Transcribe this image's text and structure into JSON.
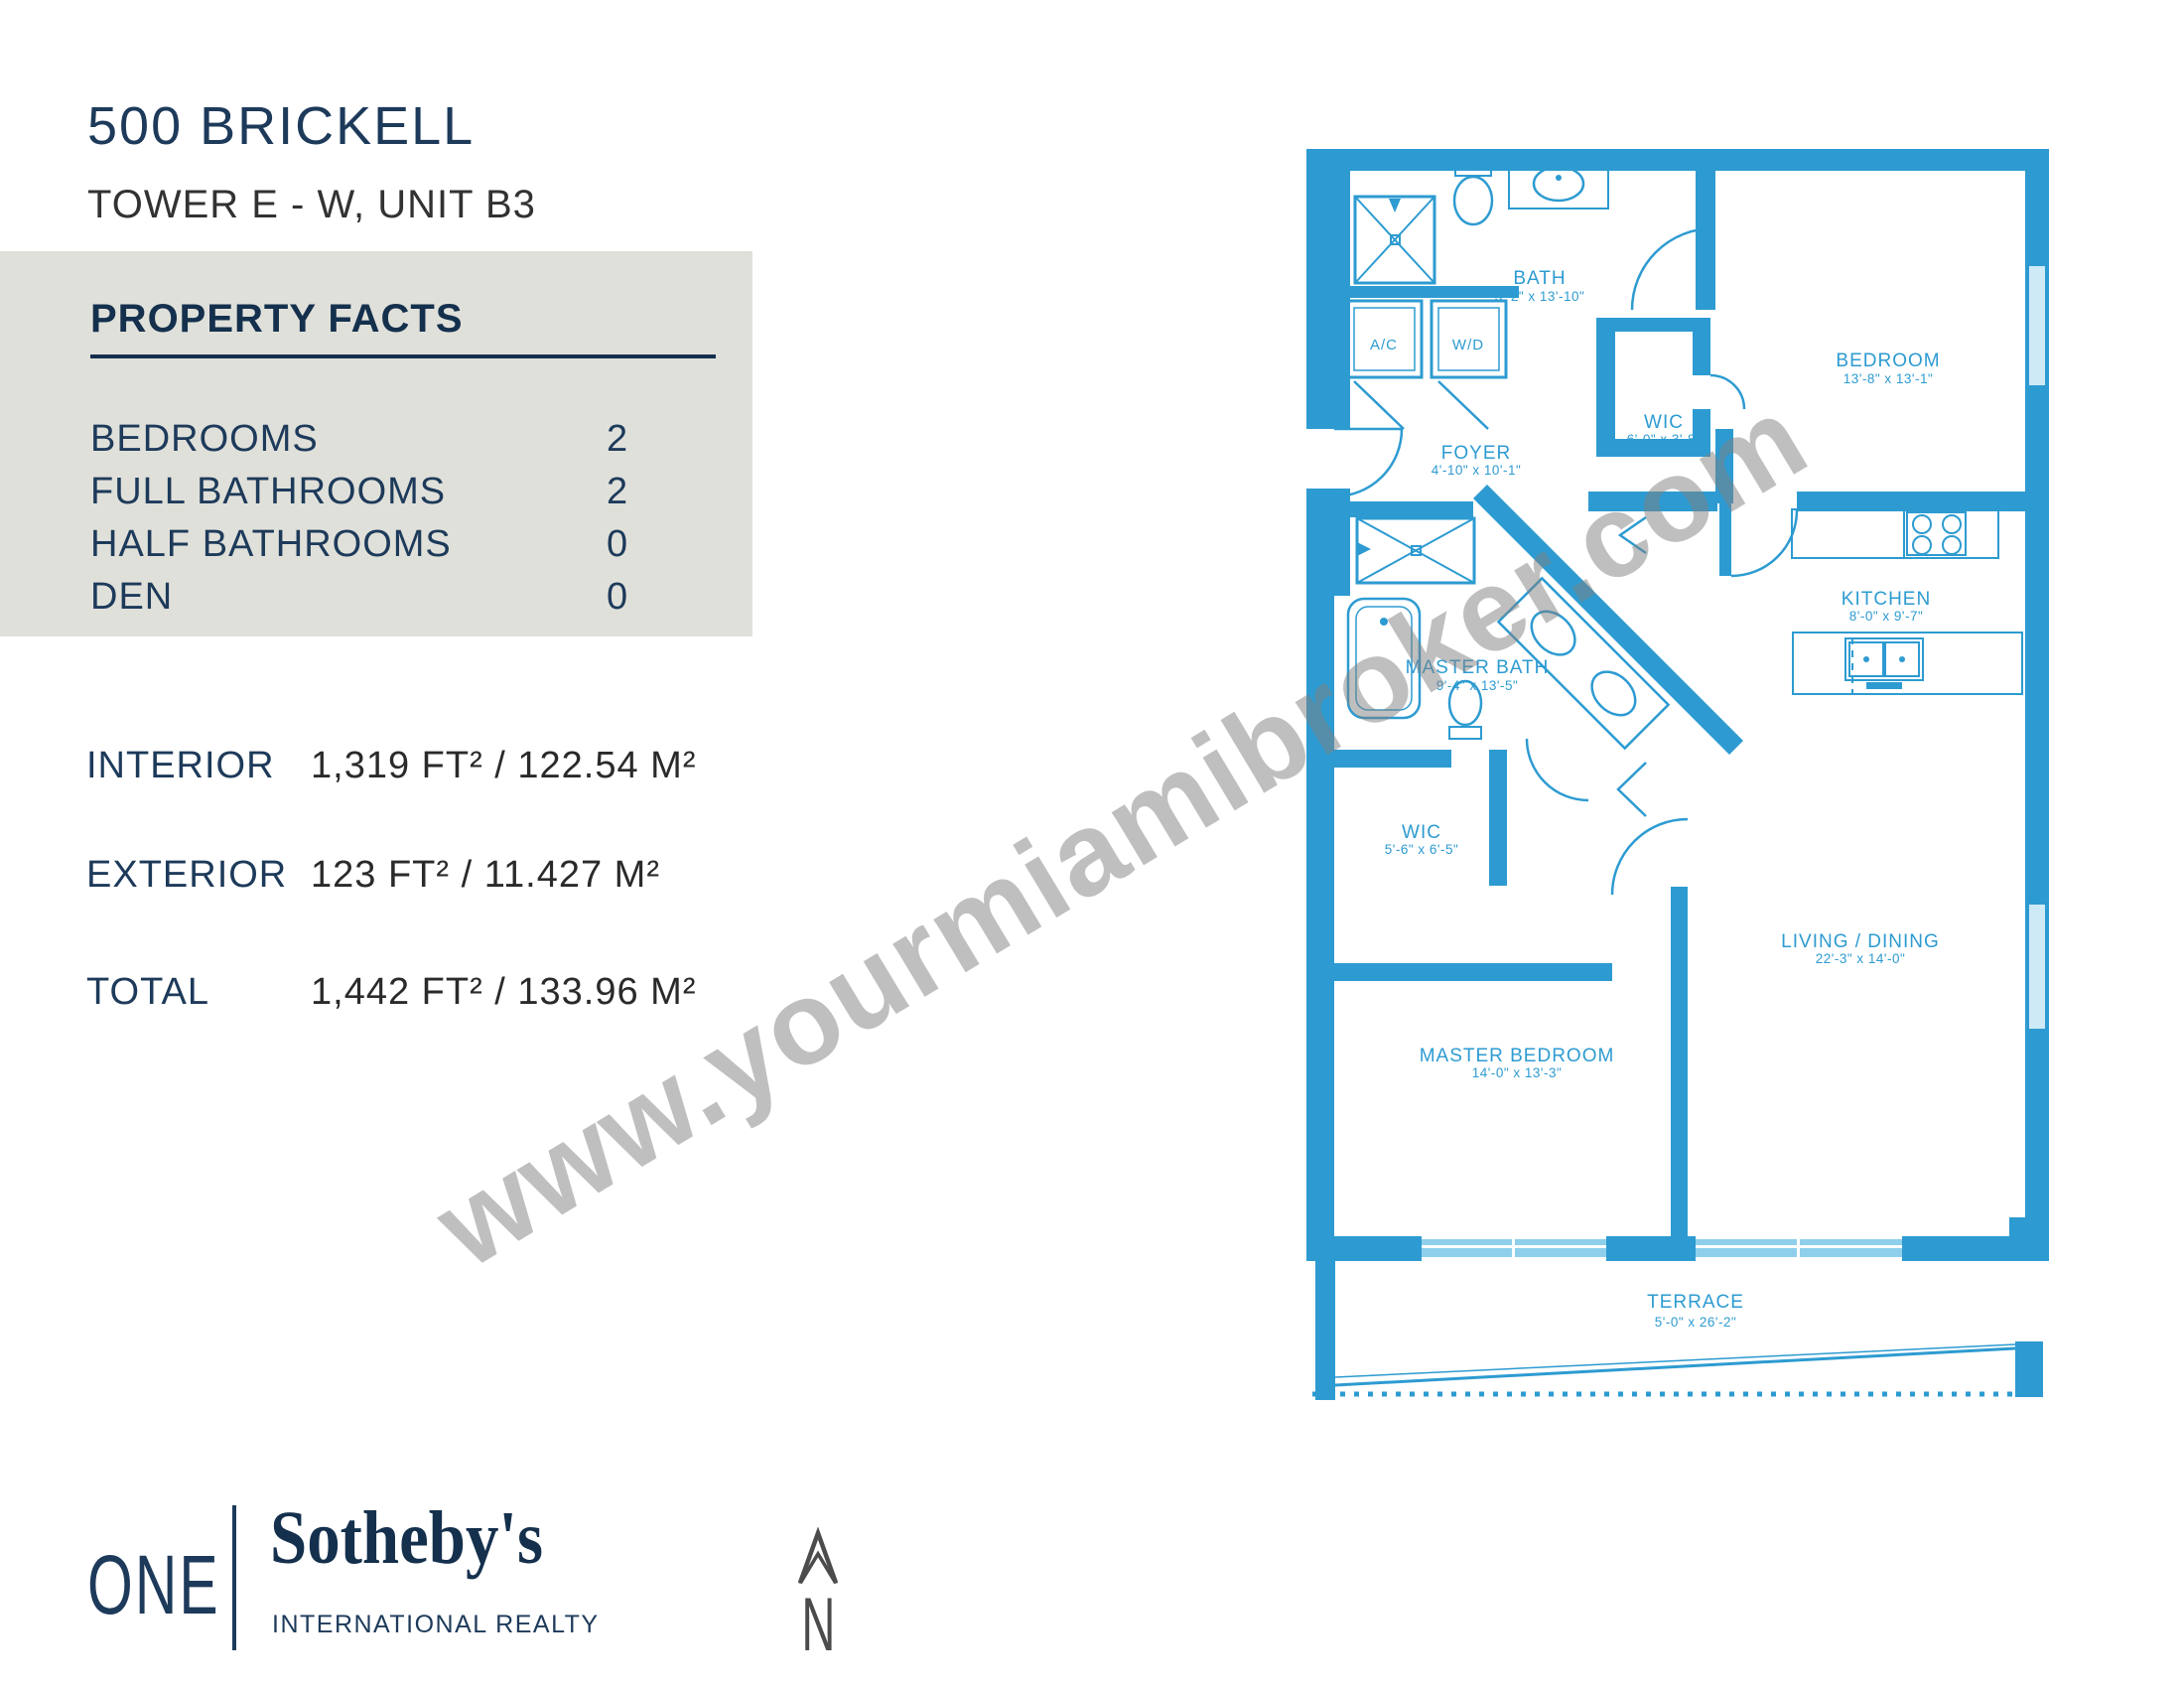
{
  "header": {
    "title": "500 BRICKELL",
    "subtitle": "TOWER E - W, UNIT B3"
  },
  "facts": {
    "heading": "PROPERTY FACTS",
    "rows": [
      {
        "label": "BEDROOMS",
        "value": "2"
      },
      {
        "label": "FULL BATHROOMS",
        "value": "2"
      },
      {
        "label": "HALF BATHROOMS",
        "value": "0"
      },
      {
        "label": "DEN",
        "value": "0"
      }
    ]
  },
  "areas": {
    "rows": [
      {
        "label": "INTERIOR",
        "value": "1,319 FT²  / 122.54 M²"
      },
      {
        "label": "EXTERIOR",
        "value": "123 FT²  / 11.427 M²"
      },
      {
        "label": "TOTAL",
        "value": "1,442 FT²  /  133.96 M²"
      }
    ]
  },
  "floorplan": {
    "accent_color": "#2d9bd1",
    "watermark": "www.yourmiamibroker.com",
    "utilities": {
      "ac": "A/C",
      "wd": "W/D"
    },
    "rooms": [
      {
        "name": "BATH",
        "dims": "5'-2\" x 13'-10\""
      },
      {
        "name": "BEDROOM",
        "dims": "13'-8\" x 13'-1\""
      },
      {
        "name": "WIC",
        "dims": "6'-0\" x 3'-8\""
      },
      {
        "name": "FOYER",
        "dims": "4'-10\" x 10'-1\""
      },
      {
        "name": "CLOSET",
        "dims": ""
      },
      {
        "name": "KITCHEN",
        "dims": "8'-0\" x 9'-7\""
      },
      {
        "name": "MASTER BATH",
        "dims": "9'-4\" x 13'-5\""
      },
      {
        "name": "WIC",
        "dims": "5'-6\" x 6'-5\""
      },
      {
        "name": "LIVING / DINING",
        "dims": "22'-3\" x 14'-0\""
      },
      {
        "name": "MASTER BEDROOM",
        "dims": "14'-0\" x 13'-3\""
      },
      {
        "name": "TERRACE",
        "dims": "5'-0\" x 26'-2\""
      }
    ]
  },
  "footer": {
    "one": "ONE",
    "sothebys": "Sotheby's",
    "tagline": "INTERNATIONAL REALTY",
    "north": "N"
  }
}
